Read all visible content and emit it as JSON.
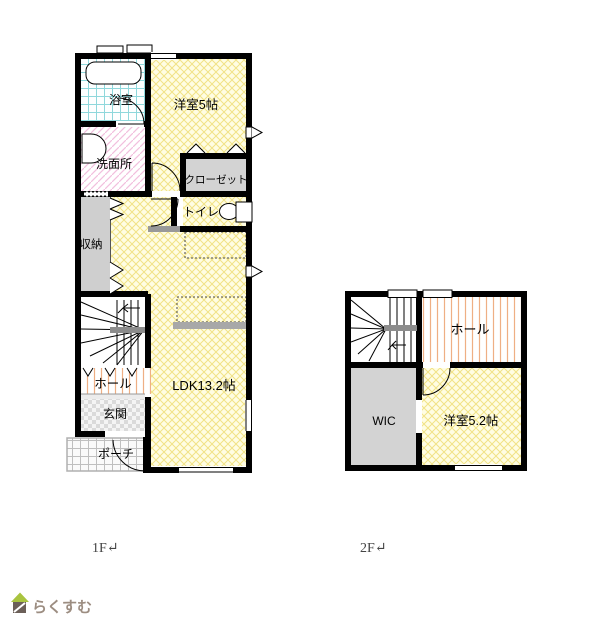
{
  "floor1": {
    "caption": "1F↵",
    "rooms": {
      "bath": "浴室",
      "washroom": "洗面所",
      "storage": "収納",
      "western_room": "洋室5帖",
      "closet": "クローゼット",
      "toilet": "トイレ",
      "ldk": "LDK13.2帖",
      "hall": "ホール",
      "entrance": "玄関",
      "porch": "ポーチ"
    }
  },
  "floor2": {
    "caption": "2F↵",
    "rooms": {
      "hall": "ホール",
      "wic": "WIC",
      "western_room": "洋室5.2帖"
    }
  },
  "logo": {
    "text": "らくすむ"
  },
  "colors": {
    "wall": "#000000",
    "tatami_yellow_line": "#F1E286",
    "bath_cyan_line": "#8FD8DC",
    "washroom_pink_line": "#F2BFDE",
    "hall_orange_line": "#EFAF84",
    "room_gray": "#D3D3D3",
    "landing_gray": "#8C8C8C",
    "counter_gray": "#A8A8A8",
    "logo_green": "#A9C43F",
    "logo_brown": "#6B5F58",
    "logo_text": "#9C8D81",
    "caption_text": "#444444"
  }
}
